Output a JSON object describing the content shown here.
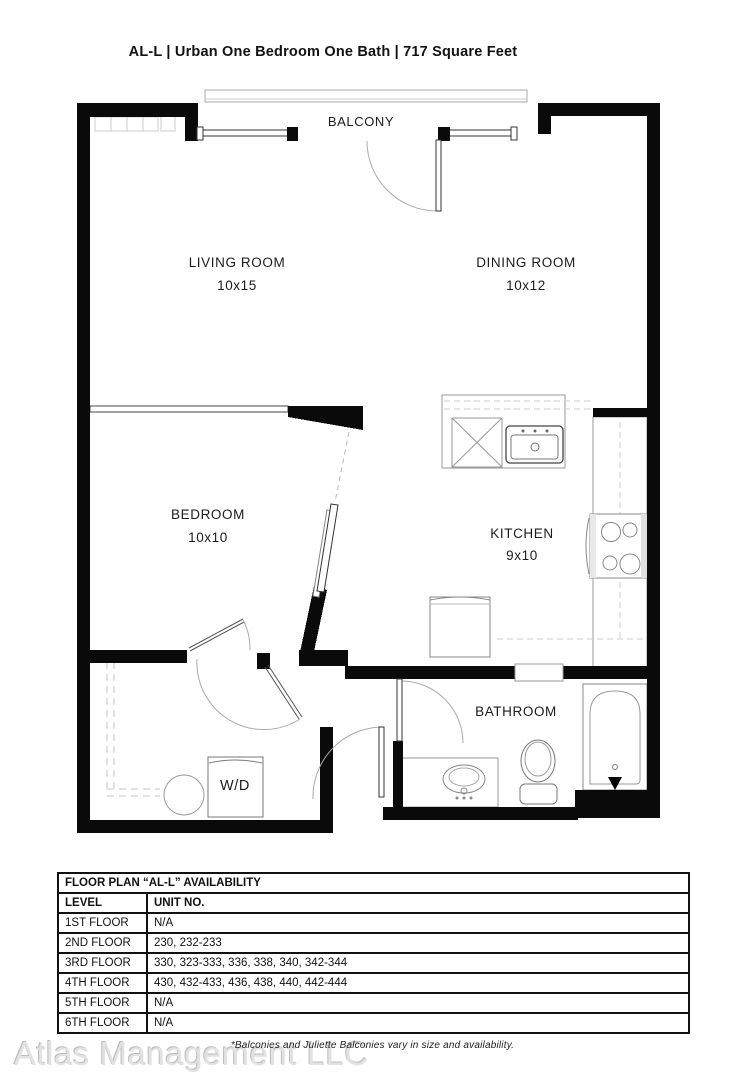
{
  "page_title": "AL-L | Urban One Bedroom One Bath | 717  Square Feet",
  "floorplan": {
    "balcony_label": "BALCONY",
    "living_room": {
      "name": "LIVING ROOM",
      "dims": "10x15"
    },
    "dining_room": {
      "name": "DINING ROOM",
      "dims": "10x12"
    },
    "bedroom": {
      "name": "BEDROOM",
      "dims": "10x10"
    },
    "kitchen": {
      "name": "KITCHEN",
      "dims": "9x10"
    },
    "bathroom": {
      "name": "BATHROOM"
    },
    "washer_dryer": {
      "name": "W/D"
    }
  },
  "availability_table": {
    "title": "FLOOR PLAN “AL-L” AVAILABILITY",
    "columns": [
      "LEVEL",
      "UNIT NO."
    ],
    "rows": [
      {
        "level": "1ST FLOOR",
        "units": "N/A"
      },
      {
        "level": "2ND FLOOR",
        "units": "230, 232-233"
      },
      {
        "level": "3RD FLOOR",
        "units": "330, 323-333, 336, 338, 340, 342-344"
      },
      {
        "level": "4TH FLOOR",
        "units": "430, 432-433, 436, 438, 440, 442-444"
      },
      {
        "level": "5TH FLOOR",
        "units": "N/A"
      },
      {
        "level": "6TH FLOOR",
        "units": "N/A"
      }
    ]
  },
  "footnote": "*Balconies and Juliette Balconies vary in size and availability.",
  "watermark": "Atlas Management LLC",
  "colors": {
    "wall": "#0a0a0a",
    "fixture_line": "#888888",
    "dash_line": "#d8d8d8"
  }
}
